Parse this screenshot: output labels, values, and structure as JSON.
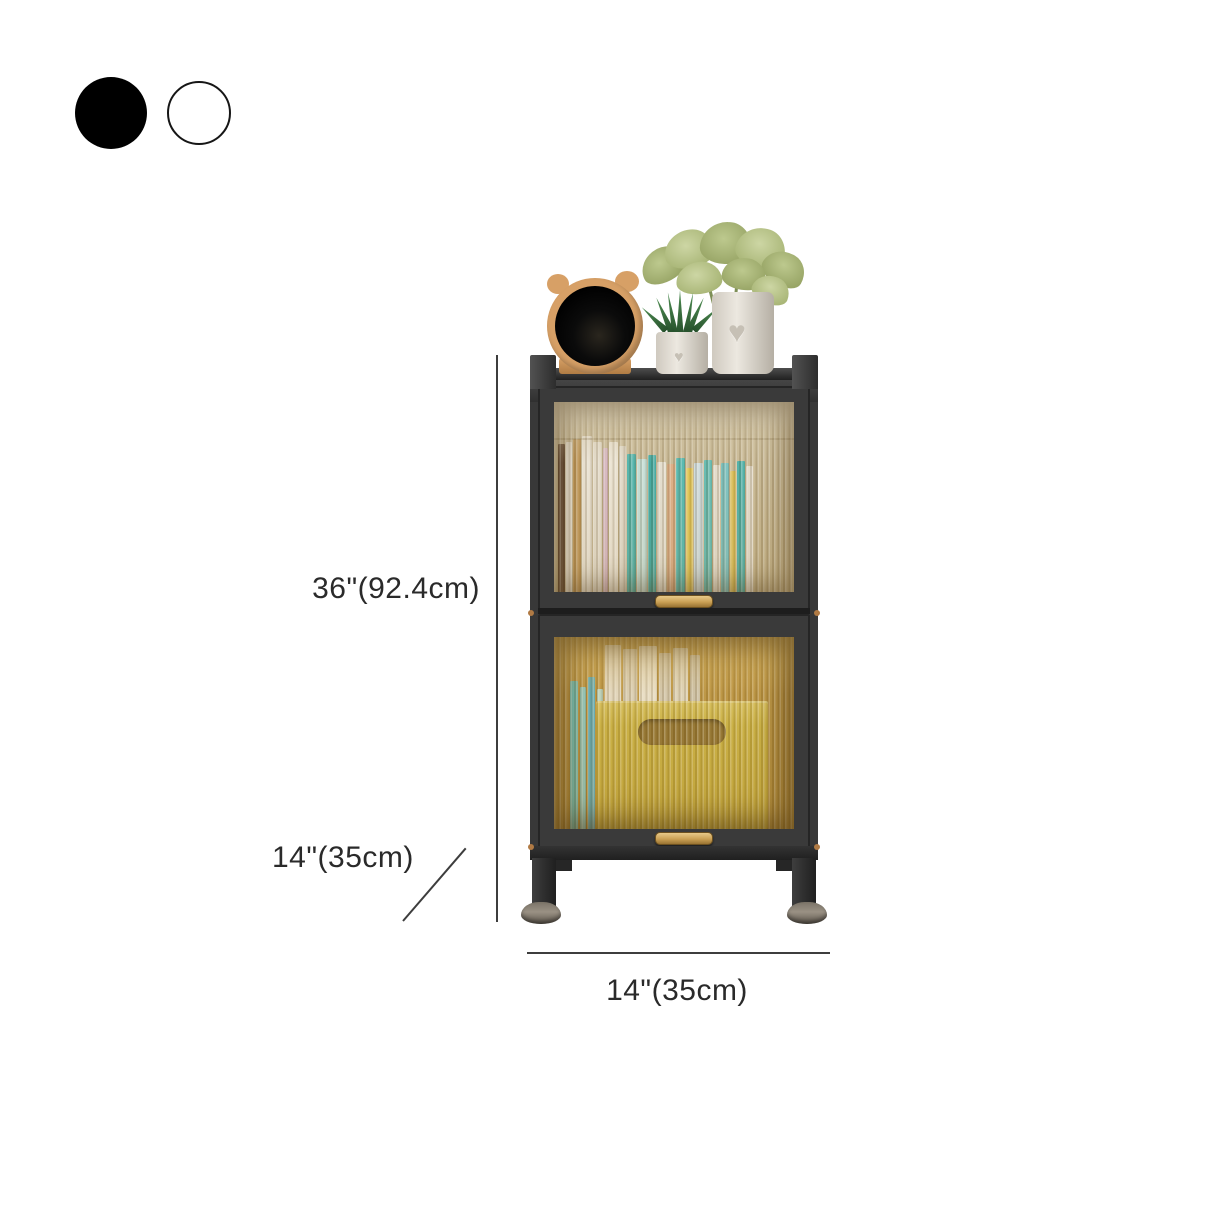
{
  "swatches": {
    "items": [
      {
        "name": "black",
        "color": "#000000",
        "outlined": false
      },
      {
        "name": "white",
        "color": "#ffffff",
        "outlined": true
      }
    ]
  },
  "annotations": {
    "height_label": "36\"(92.4cm)",
    "depth_label": "14\"(35cm)",
    "width_label": "14\"(35cm)"
  },
  "product": {
    "frame_color": "#383838",
    "glass_tint_upper": "#c9bc99",
    "glass_tint_lower": "#b8933f",
    "handle_color": "#caa054",
    "storage_box_color": "#cdb640",
    "foot_color": "#8d8478",
    "clock_color": "#d7a066",
    "dimension_line_color": "#3d3d3d"
  },
  "decor": {
    "upper_books": [
      {
        "c": "#5a4030",
        "w": 7,
        "h": 148
      },
      {
        "c": "#ece6da",
        "w": 6,
        "h": 150
      },
      {
        "c": "#c59a58",
        "w": 8,
        "h": 153
      },
      {
        "c": "#efe9dd",
        "w": 10,
        "h": 156
      },
      {
        "c": "#e7e0d2",
        "w": 9,
        "h": 150
      },
      {
        "c": "#d9b9c9",
        "w": 5,
        "h": 144
      },
      {
        "c": "#f0eadd",
        "w": 9,
        "h": 150
      },
      {
        "c": "#e3ddd0",
        "w": 7,
        "h": 146
      },
      {
        "c": "#41b4b1",
        "w": 9,
        "h": 138
      },
      {
        "c": "#c3e4e1",
        "w": 10,
        "h": 133
      },
      {
        "c": "#2fa8a5",
        "w": 8,
        "h": 137
      },
      {
        "c": "#e9e5da",
        "w": 9,
        "h": 130
      },
      {
        "c": "#dfae86",
        "w": 8,
        "h": 128
      },
      {
        "c": "#47b9b5",
        "w": 9,
        "h": 134
      },
      {
        "c": "#e5c94f",
        "w": 7,
        "h": 124
      },
      {
        "c": "#cfe1ea",
        "w": 9,
        "h": 129
      },
      {
        "c": "#58bdb8",
        "w": 8,
        "h": 132
      },
      {
        "c": "#e8e2d5",
        "w": 7,
        "h": 127
      },
      {
        "c": "#72c4c8",
        "w": 8,
        "h": 129
      },
      {
        "c": "#dec255",
        "w": 6,
        "h": 121
      },
      {
        "c": "#3fb0ad",
        "w": 8,
        "h": 131
      },
      {
        "c": "#e6e0d3",
        "w": 7,
        "h": 126
      }
    ],
    "lower_items": [
      {
        "c": "#5fc3c6",
        "w": 8,
        "h": 148
      },
      {
        "c": "#8ad2d4",
        "w": 6,
        "h": 142
      },
      {
        "c": "#4fb0cd",
        "w": 7,
        "h": 152
      },
      {
        "c": "#b7dcd4",
        "w": 6,
        "h": 140
      },
      {
        "c": "#eae4d7",
        "w": 16,
        "h": 184
      },
      {
        "c": "#dfd8c9",
        "w": 14,
        "h": 180
      },
      {
        "c": "#f1ece0",
        "w": 18,
        "h": 183
      },
      {
        "c": "#d7d0c1",
        "w": 12,
        "h": 176
      },
      {
        "c": "#e5dfd0",
        "w": 15,
        "h": 181
      },
      {
        "c": "#cfc8b9",
        "w": 10,
        "h": 174
      }
    ]
  }
}
